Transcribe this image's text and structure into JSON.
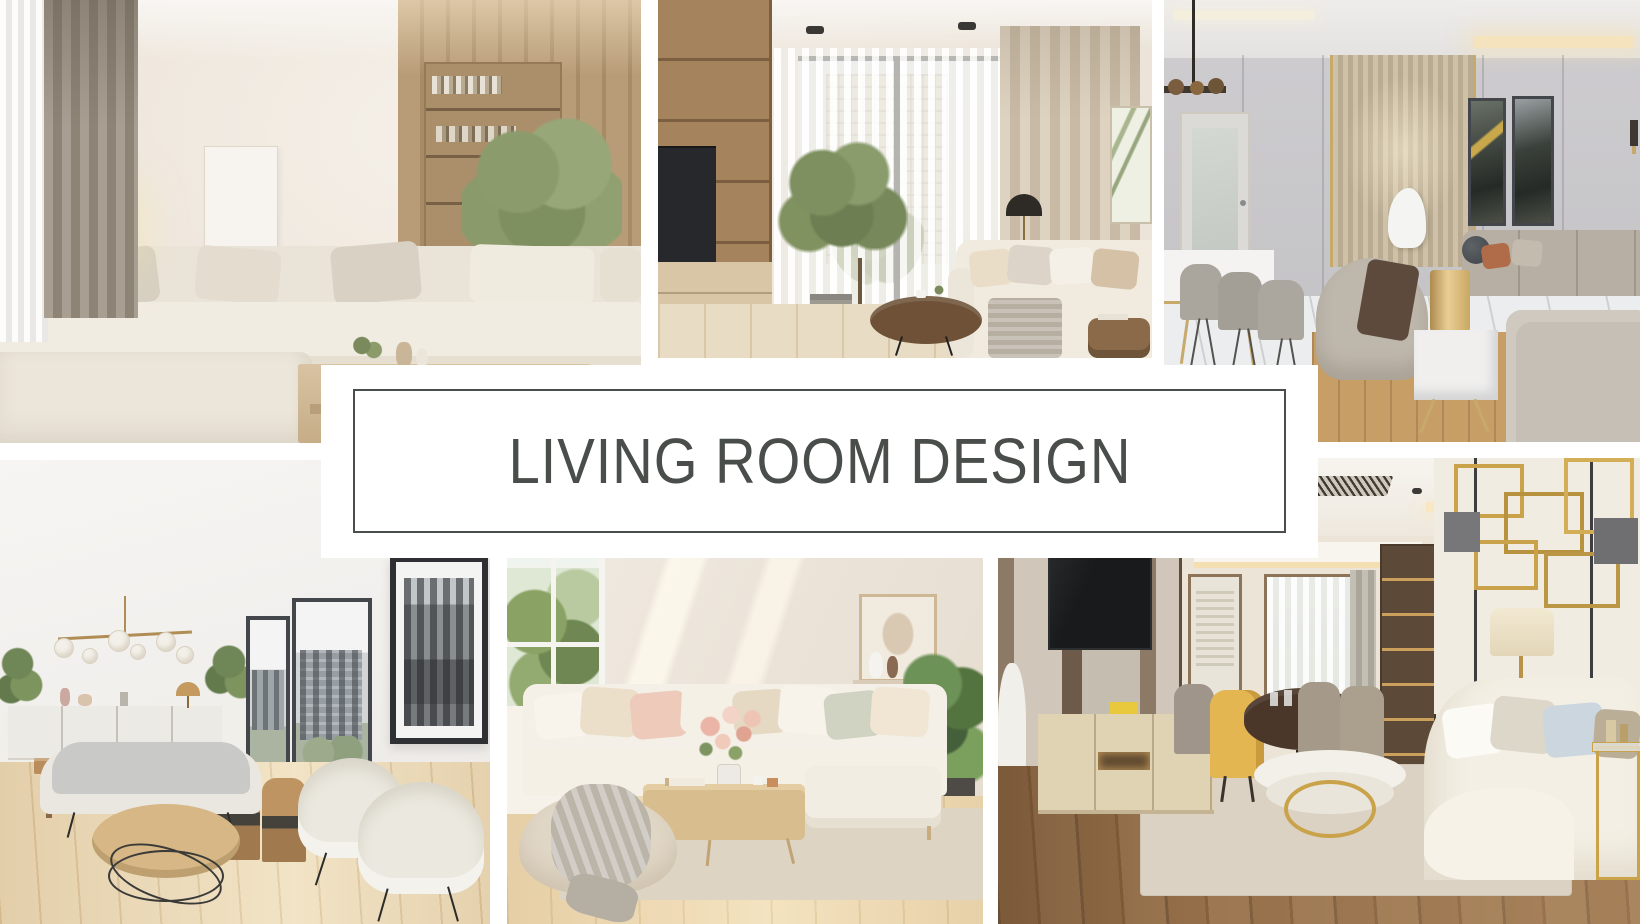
{
  "page": {
    "background_color": "#ffffff",
    "kind": "interior design mood board collage"
  },
  "banner": {
    "title": "LIVING ROOM DESIGN",
    "text_color": "#4a4e4b",
    "border_color": "#4a4e4b",
    "background_color": "#ffffff"
  },
  "palette": {
    "cream": "#f2ede3",
    "beige": "#e8dcc5",
    "wood_light": "#d6b785",
    "wood_dark": "#8a6748",
    "gold_accent": "#c9a24a",
    "greenery": "#6f8752"
  },
  "photos": [
    {
      "id": "top-left",
      "description": "Bright beige living room with cream modular sectional sofa, glowing egg-shaped pendant lamp, taupe drapes, sheer curtain, wall art, wooden shelving with books, indoor tree and low wood coffee table with vases"
    },
    {
      "id": "top-middle",
      "description": "Living room with floor-to-ceiling window and sheer curtains, beige drapes, potted ficus tree, wood TV wall unit, black dome floor lamp, cream sofa with throw and round dark wood coffee table"
    },
    {
      "id": "top-right",
      "description": "Elegant greige living-dining room with marble floor, champagne slatted feature wall with gold trim, dark abstract artworks, wood-disc pendant, marble dining table with taupe chairs, barrel chair, brass cylinder lamp on marble cube table and beige sofas"
    },
    {
      "id": "bottom-left",
      "description": "Scandinavian white living room with brass globe chandelier, white sideboard, wood dining table and chairs, black-framed windows with city view, monochrome skyline artwork, gray bench sofa, two cream shell armchairs and round wood coffee table on wire base"
    },
    {
      "id": "bottom-middle",
      "description": "Airy living room with white-framed garden window, cream corner sofa with blush and sage cushions, wood coffee table with pink flower vase and books, knit throw over beige pouf, wall shelf with art and vases, and green plant"
    },
    {
      "id": "bottom-right",
      "description": "Warm contemporary living room with wood and marble TV wall, mounted TV, light wood console, dining nook with round dark table, mustard and taupe chairs, lit shelving, brass geometric wall art, cream sofa, gold round coffee table and glass side table"
    }
  ]
}
